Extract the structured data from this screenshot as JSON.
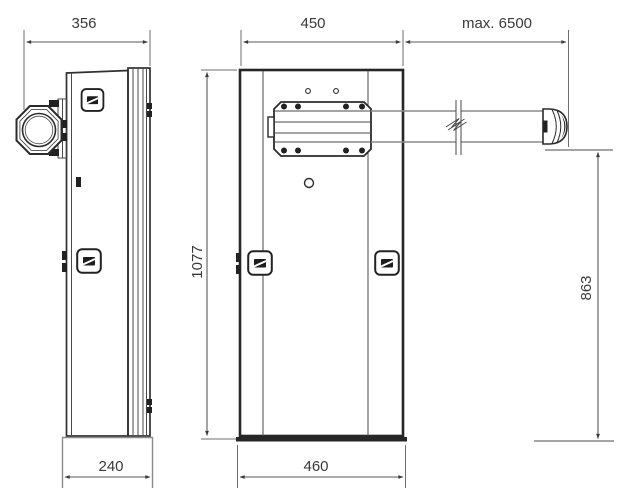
{
  "drawing": {
    "title": "barrier-gate-dimension-drawing",
    "background": "#ffffff",
    "line_color": "#2b2b2b",
    "dim_color": "#3a3a3a",
    "views": {
      "side": {
        "top_width": "356",
        "bottom_width": "240"
      },
      "front": {
        "top_width": "450",
        "boom_length": "max. 6500",
        "cabinet_height": "1077",
        "boom_height": "863",
        "bottom_width": "460"
      }
    },
    "icons": {
      "door_lock": "lock-icon"
    }
  }
}
